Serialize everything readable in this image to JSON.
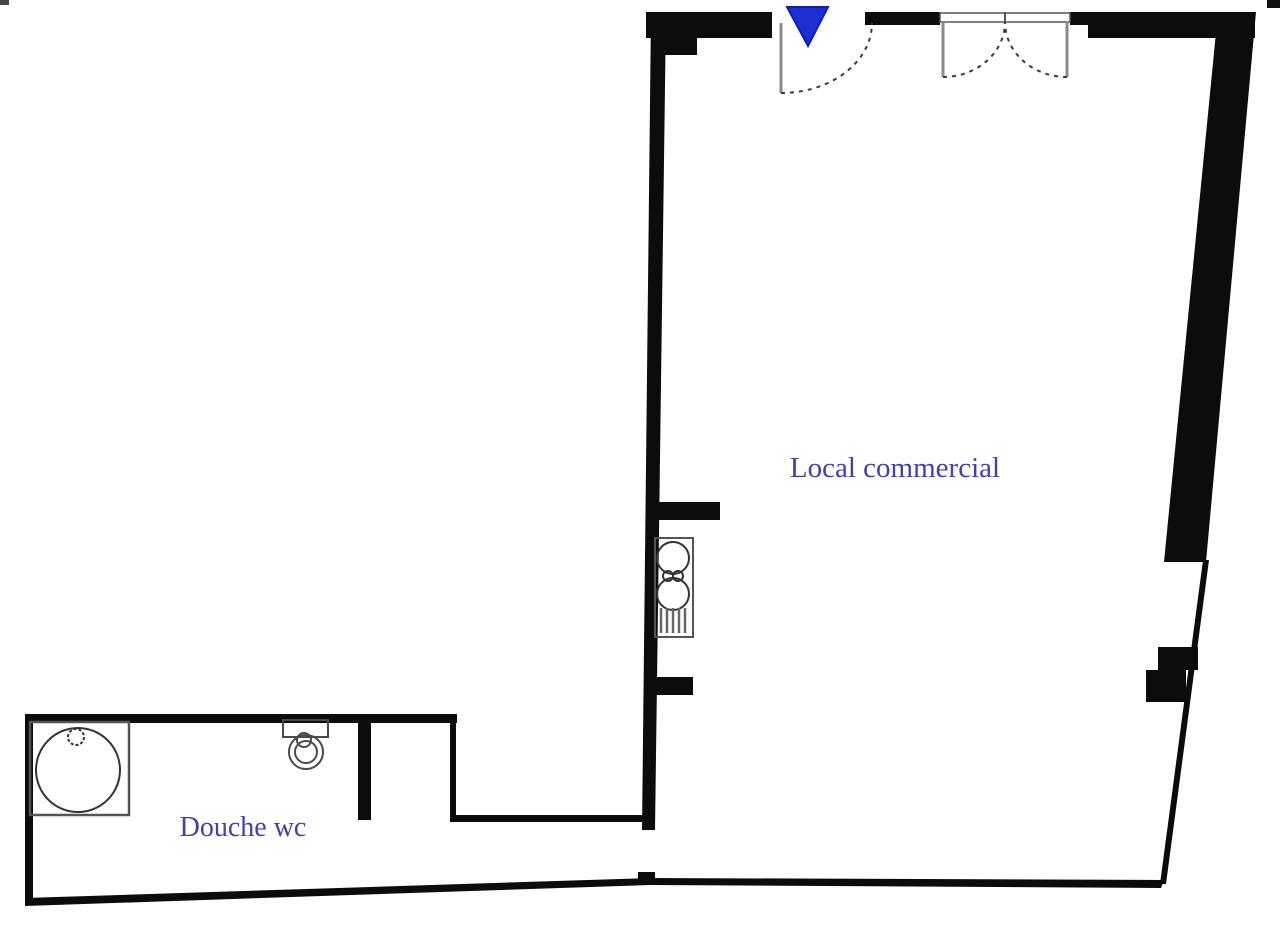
{
  "plan": {
    "type": "floor-plan",
    "background": "#ffffff",
    "labels": {
      "main_room": "Local commercial",
      "bathroom": "Douche wc"
    },
    "rooms": [
      {
        "id": "local-commercial",
        "label": "Local commercial"
      },
      {
        "id": "douche-wc",
        "label": "Douche wc"
      }
    ],
    "colors": {
      "wall": "#0c0c0c",
      "thin_line": "#2a2a2a",
      "fixture_line": "#4a4a4a",
      "door_leaf": "#8a8a8a",
      "label_text": "#4040b2",
      "entrance_marker": "#1c2fd4",
      "entrance_marker_border": "#1021a8"
    },
    "icons": [
      {
        "name": "entrance-arrow-icon",
        "shape": "filled downward triangle",
        "color": "#1c2fd4"
      }
    ],
    "doors": [
      "entrance-single-swing-door",
      "double-swing-door"
    ],
    "fixtures": [
      "shower-tray",
      "toilet",
      "kitchenette-sink"
    ]
  }
}
